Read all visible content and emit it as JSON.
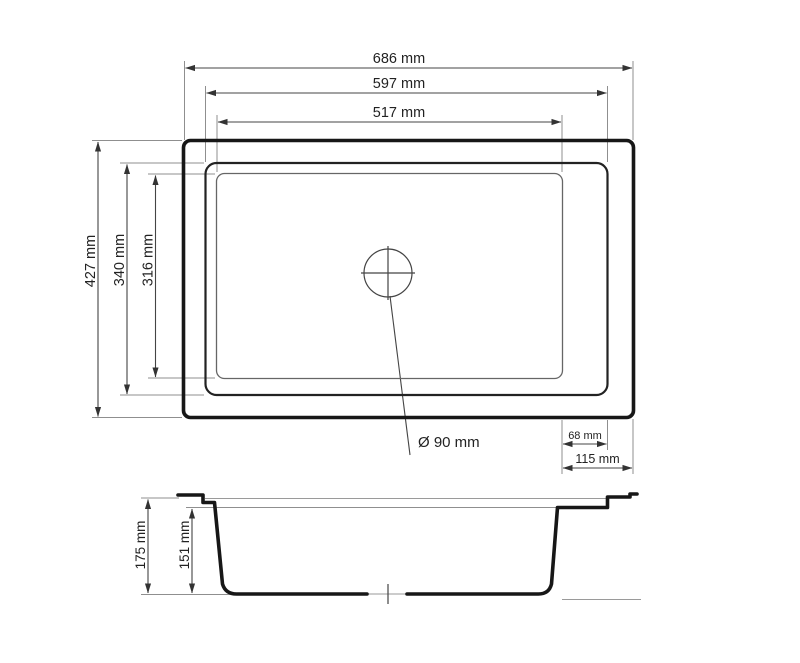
{
  "top_view": {
    "width_outer_label": "686 mm",
    "width_rim_label": "597 mm",
    "width_bowl_label": "517 mm",
    "depth_outer_label": "427 mm",
    "depth_rim_label": "340 mm",
    "depth_bowl_label": "316 mm",
    "right_ledge_small_label": "68 mm",
    "right_ledge_large_label": "115 mm",
    "drain_label": "Ø 90 mm"
  },
  "front_view": {
    "height_outer_label": "175 mm",
    "height_bowl_label": "151 mm"
  },
  "colors": {
    "background": "#ffffff",
    "outline": "#171717",
    "secondary_outline": "#666666",
    "dimension_line": "#444444",
    "extension_line": "#8f8f8f",
    "text": "#222222"
  }
}
